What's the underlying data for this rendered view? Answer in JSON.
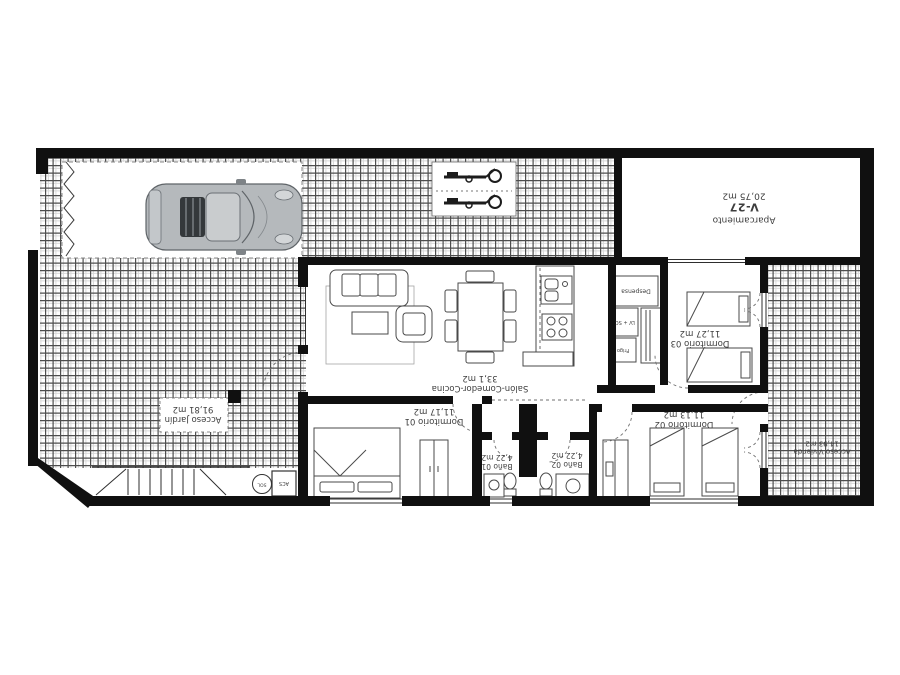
{
  "plan": {
    "rooms": {
      "aparcamiento": {
        "name": "Aparcamiento",
        "code": "V-27",
        "area": "20,75 m2"
      },
      "salon": {
        "name": "Salón-Comedor-Cocina",
        "area": "33,1 m2"
      },
      "dormitorio1": {
        "name": "Dormitorio 01",
        "area": "11,17 m2"
      },
      "dormitorio2": {
        "name": "Dormitorio 02",
        "area": "11,13 m2"
      },
      "dormitorio3": {
        "name": "Dormitorio 03",
        "area": "11,27 m2"
      },
      "bano1": {
        "name": "Baño 01",
        "area": "4,22 m2"
      },
      "bano2": {
        "name": "Baño 02",
        "area": "4,22 m2"
      },
      "jardin": {
        "name": "Acceso Jardín",
        "area": "91,81 m2"
      },
      "acceso": {
        "name": "Acceso Vivienda",
        "area": "14,93 m2"
      }
    },
    "fixtures": {
      "despensa": "Despensa",
      "lavadora": "LV + SC",
      "frigo": "Frigo",
      "sol": "SOL",
      "acs": "ACS"
    },
    "colors": {
      "wall": "#101010",
      "hatch_line": "#4d4d4d",
      "furniture_line": "#4a4a4a",
      "label_text": "#3e3e3e",
      "car_body": "#b5b9bc"
    }
  }
}
